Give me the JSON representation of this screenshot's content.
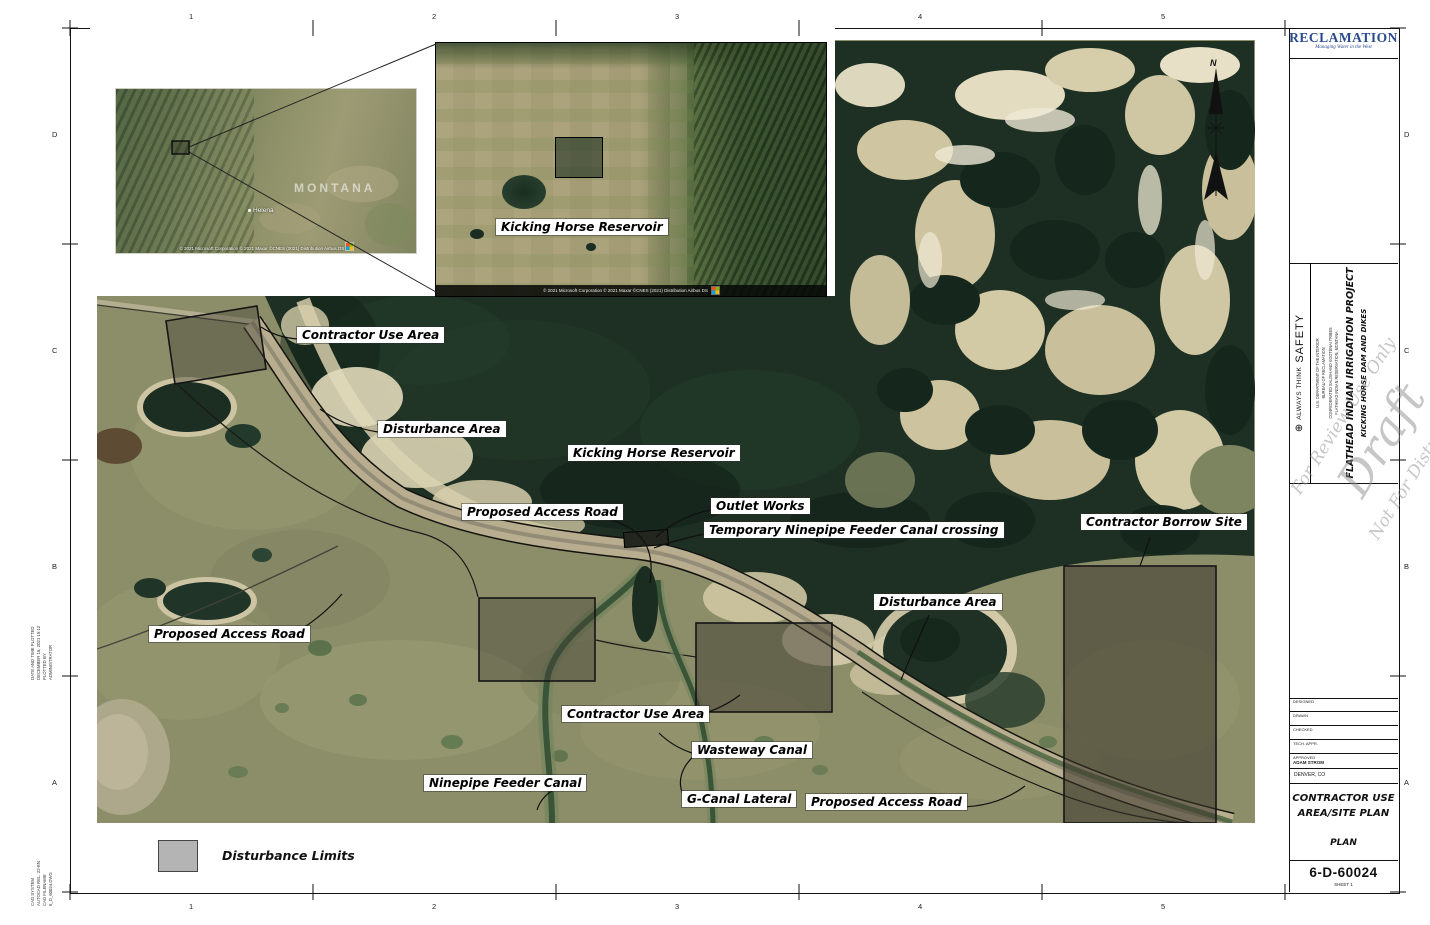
{
  "sheet": {
    "grid_columns": [
      "1",
      "2",
      "3",
      "4",
      "5"
    ],
    "grid_rows": [
      "D",
      "C",
      "B",
      "A"
    ],
    "margin_note_plot": [
      "DATE AND TIME PLOTTED",
      "DECEMBER 16, 2021  15:12",
      "PLOTTED BY",
      "ADMINISTRATOR"
    ],
    "margin_note_cad": [
      "CAD SYSTEM",
      "AUTOCAD REL. 22-EN",
      "CAD FILENAME",
      "6_D_60024.DWG"
    ]
  },
  "logo": {
    "name": "RECLAMATION",
    "tagline": "Managing Water in the West"
  },
  "watermark": {
    "line1": "For Review Use Only",
    "line2": "Draft",
    "line3": "Not For Distribution"
  },
  "title_block": {
    "safety_think": "ALWAYS  THINK",
    "safety_word": "SAFETY",
    "agency_lines": [
      "U.S. DEPARTMENT OF THE INTERIOR",
      "BUREAU OF RECLAMATION",
      "CONFEDERATED SALISH AND KOOTENAI TRIBES",
      "FLATHEAD INDIAN RESERVATION, MONTANA"
    ],
    "project": "FLATHEAD  INDIAN  IRRIGATION  PROJECT",
    "feature": "KICKING  HORSE  DAM  AND  DIKES",
    "approval_rows": [
      "DESIGNED",
      "DRAWN",
      "CHECKED",
      "TECH. APPR.",
      "APPROVED"
    ],
    "approved_name": "ADAM STROM",
    "office": "DENVER,  CO",
    "drawing_title_1": "CONTRACTOR  USE",
    "drawing_title_2": "AREA/SITE  PLAN",
    "view_label": "PLAN",
    "drawing_number": "6-D-60024",
    "sheet_label": "SHEET  1"
  },
  "insets": {
    "state": {
      "name": "MONTANA",
      "city": "Helena",
      "attribution": "© 2021 Microsoft Corporation © 2021 Maxar ©CNES (2021) Distribution Airbus DS"
    },
    "regional": {
      "label": "Kicking Horse Reservoir",
      "attribution": "© 2021 Microsoft Corporation © 2021 Maxar ©CNES (2021) Distribution Airbus DS"
    }
  },
  "map": {
    "north_label": "N",
    "labels": [
      {
        "text": "Contractor Use Area"
      },
      {
        "text": "Disturbance Area"
      },
      {
        "text": "Kicking Horse Reservoir"
      },
      {
        "text": "Proposed Access Road"
      },
      {
        "text": "Outlet Works"
      },
      {
        "text": "Temporary Ninepipe Feeder Canal crossing"
      },
      {
        "text": "Contractor Borrow Site"
      },
      {
        "text": "Disturbance Area"
      },
      {
        "text": "Proposed Access Road"
      },
      {
        "text": "Contractor Use Area"
      },
      {
        "text": "Wasteway Canal"
      },
      {
        "text": "Ninepipe Feeder Canal"
      },
      {
        "text": "G-Canal Lateral"
      },
      {
        "text": "Proposed Access Road"
      }
    ]
  },
  "legend": {
    "label": "Disturbance Limits",
    "swatch_color": "#b4b4b4"
  },
  "colors": {
    "accent_navy": "#2a4a8e",
    "water": "#1d3023",
    "land": "#8c8e6a",
    "sand": "#d5cca9"
  }
}
